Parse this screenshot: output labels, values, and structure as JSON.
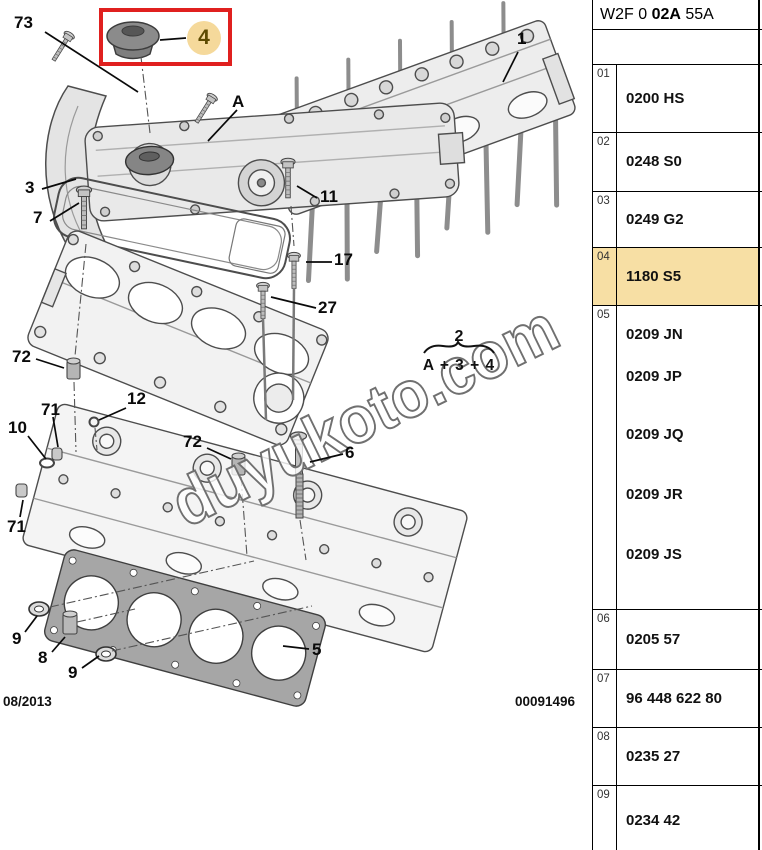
{
  "parts_table": {
    "header": {
      "prefix": "W2F 0 ",
      "bold": "02A",
      "suffix": " 55A"
    },
    "rows": [
      {
        "num": "01",
        "codes": [
          "0200 HS"
        ],
        "highlighted": false
      },
      {
        "num": "02",
        "codes": [
          "0248 S0"
        ],
        "highlighted": false
      },
      {
        "num": "03",
        "codes": [
          "0249 G2"
        ],
        "highlighted": false
      },
      {
        "num": "04",
        "codes": [
          "1180 S5"
        ],
        "highlighted": true
      },
      {
        "num": "05",
        "codes": [
          "0209 JN",
          "0209 JP",
          "0209 JQ",
          "0209 JR",
          "0209 JS"
        ],
        "highlighted": false
      },
      {
        "num": "06",
        "codes": [
          "0205 57"
        ],
        "highlighted": false
      },
      {
        "num": "07",
        "codes": [
          "96 448 622 80"
        ],
        "highlighted": false
      },
      {
        "num": "08",
        "codes": [
          "0235 27"
        ],
        "highlighted": false
      },
      {
        "num": "09",
        "codes": [
          "0234 42"
        ],
        "highlighted": false
      }
    ]
  },
  "diagram": {
    "highlighted_callout": {
      "label": "4"
    },
    "callouts": [
      {
        "label": "73",
        "x": 14,
        "y": 14
      },
      {
        "label": "3",
        "x": 25,
        "y": 179
      },
      {
        "label": "7",
        "x": 33,
        "y": 209
      },
      {
        "label": "A",
        "x": 232,
        "y": 93
      },
      {
        "label": "1",
        "x": 517,
        "y": 30
      },
      {
        "label": "11",
        "x": 320,
        "y": 188
      },
      {
        "label": "17",
        "x": 334,
        "y": 251
      },
      {
        "label": "27",
        "x": 318,
        "y": 299
      },
      {
        "label": "72",
        "x": 12,
        "y": 348
      },
      {
        "label": "12",
        "x": 127,
        "y": 390
      },
      {
        "label": "71",
        "x": 41,
        "y": 401
      },
      {
        "label": "10",
        "x": 8,
        "y": 419
      },
      {
        "label": "71",
        "x": 7,
        "y": 518
      },
      {
        "label": "72",
        "x": 183,
        "y": 433
      },
      {
        "label": "6",
        "x": 345,
        "y": 444
      },
      {
        "label": "9",
        "x": 12,
        "y": 630
      },
      {
        "label": "8",
        "x": 38,
        "y": 649
      },
      {
        "label": "9",
        "x": 68,
        "y": 664
      },
      {
        "label": "5",
        "x": 312,
        "y": 641
      }
    ],
    "formula": {
      "top": "2",
      "bottom": "A + 3 + 4"
    },
    "watermark": "duyukoto.com",
    "footer": {
      "date": "08/2013",
      "doc_number": "00091496"
    }
  },
  "colors": {
    "row_highlight": "#f7dfa4",
    "selection_box": "#e0201f",
    "callout_badge": "#f5d99b",
    "callout_badge_text": "#5d4a00",
    "watermark_stroke": "#707070"
  }
}
